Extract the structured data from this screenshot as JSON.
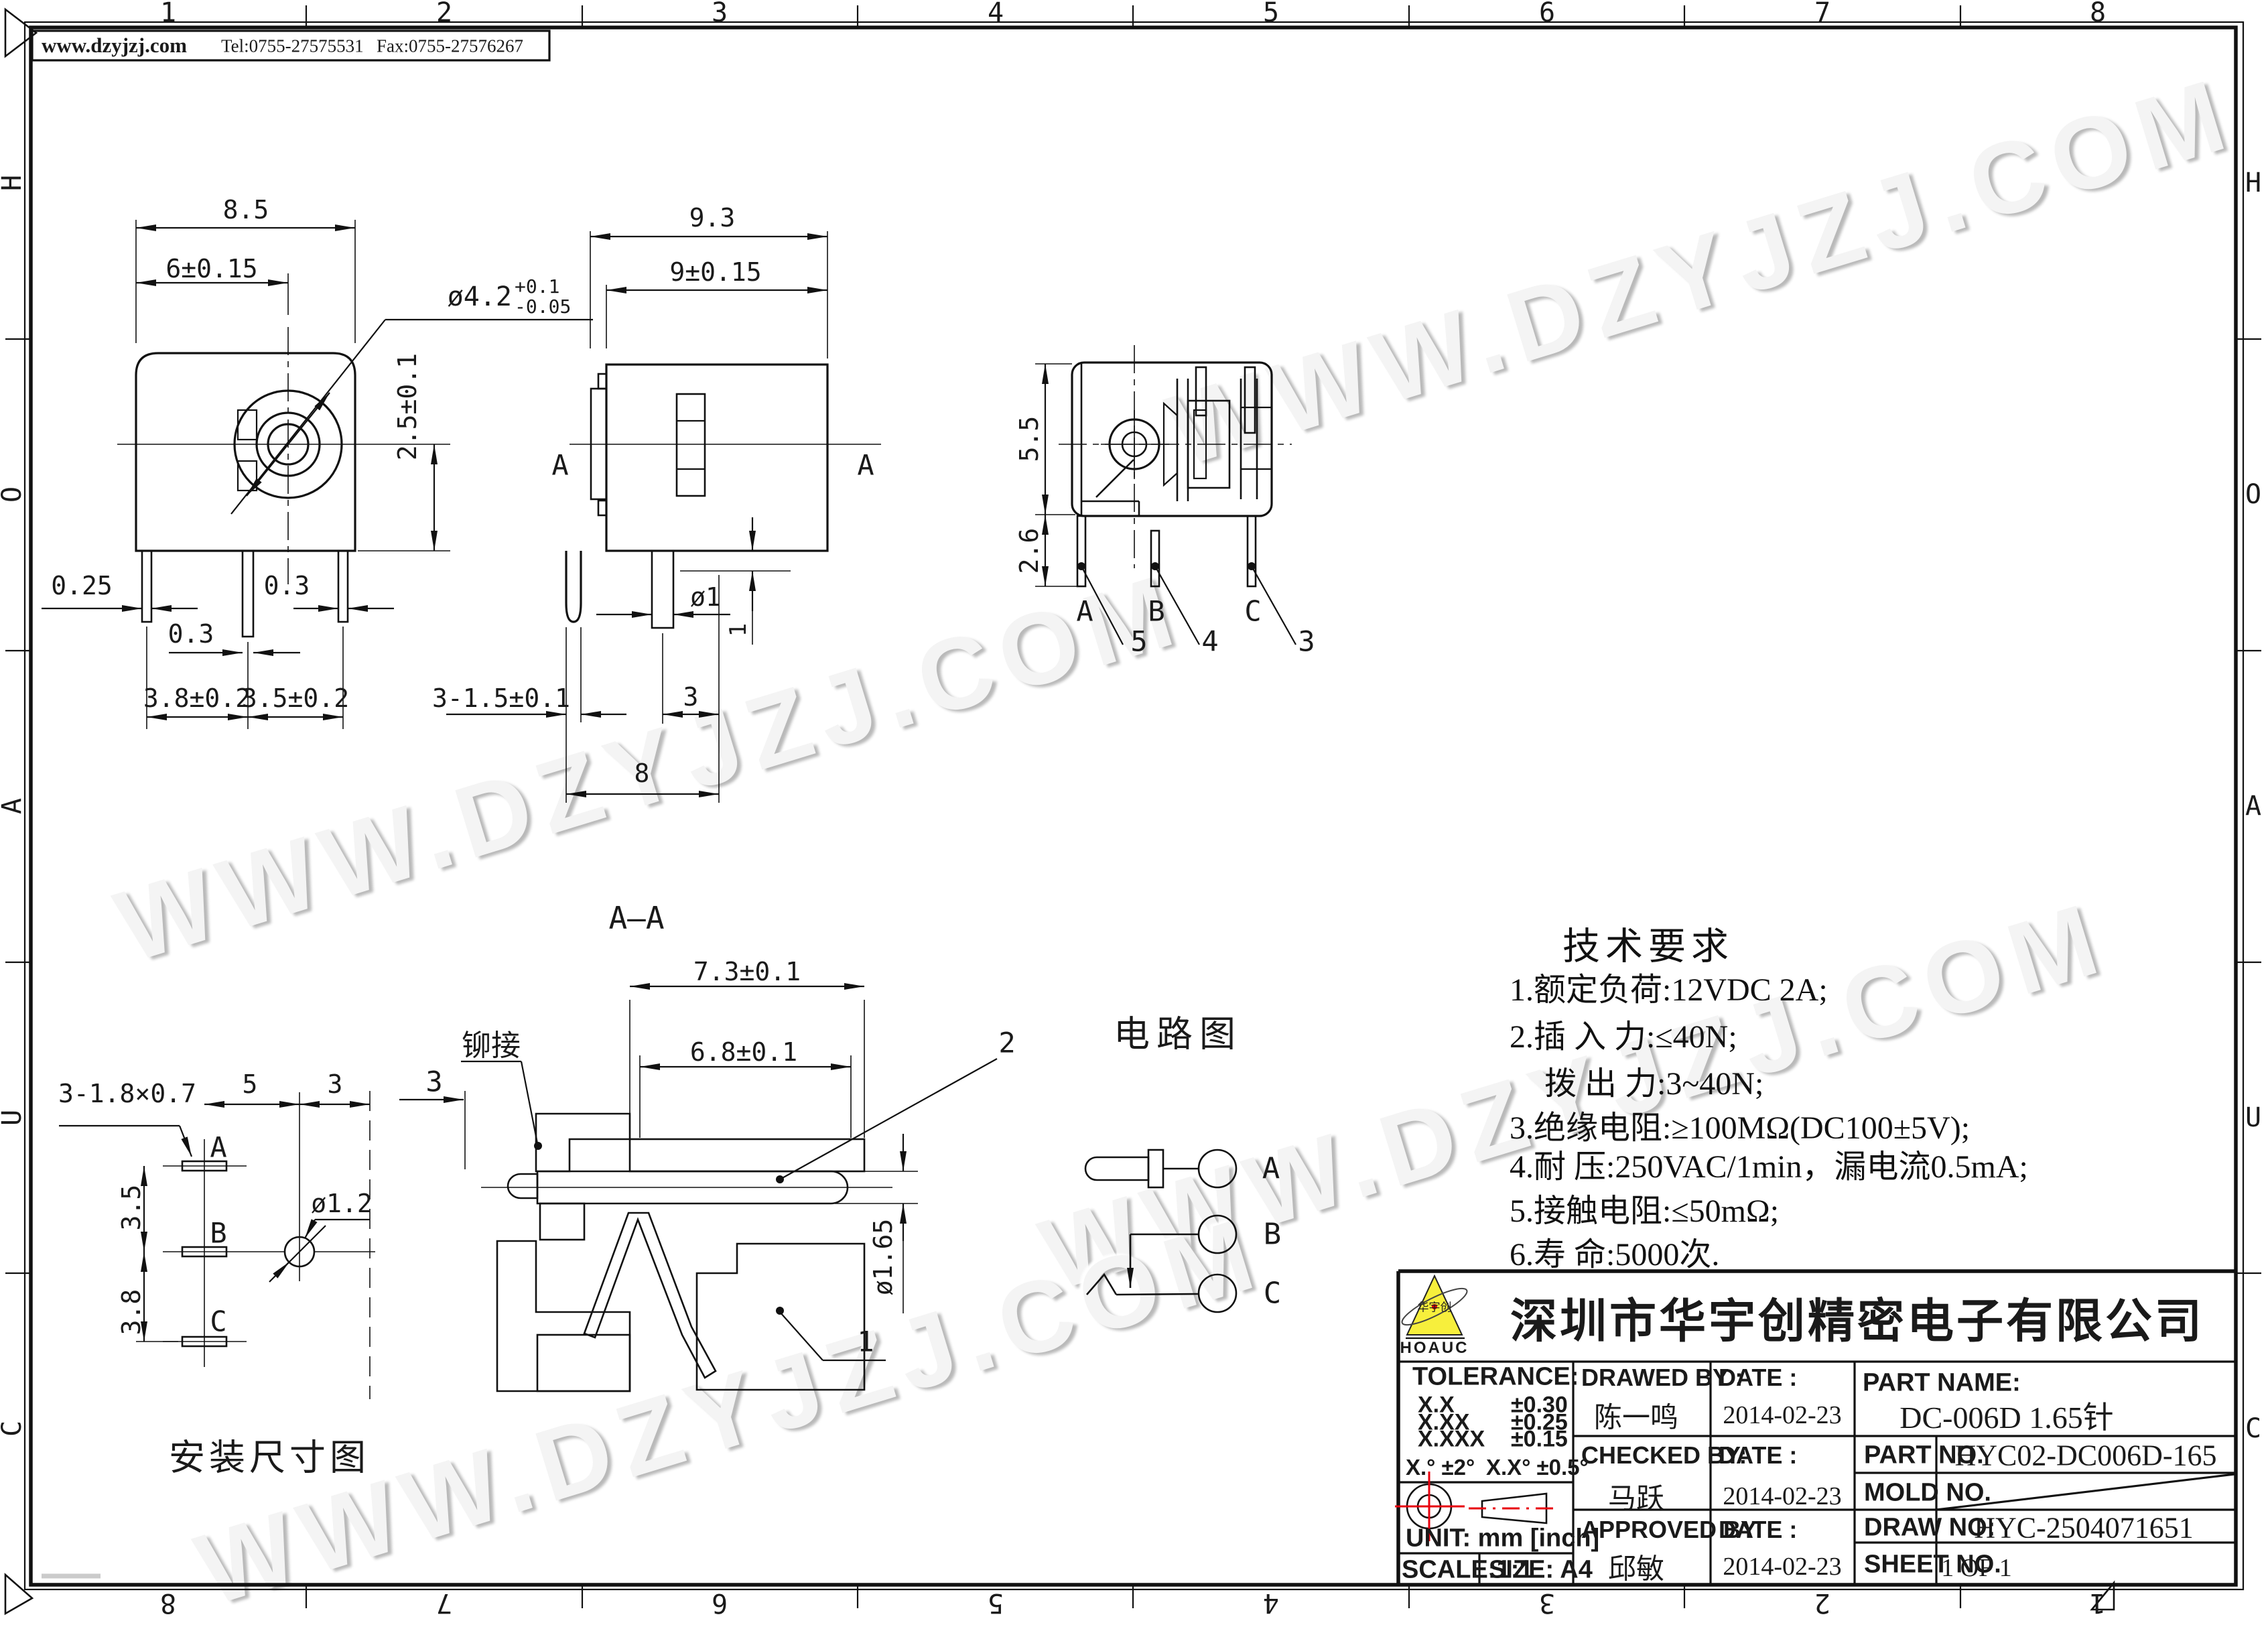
{
  "watermark": "WWW.DZYJZJ.COM",
  "header": {
    "website": "www.dzyjzj.com",
    "tel": "Tel:0755-27575531",
    "fax": "Fax:0755-27576267"
  },
  "border": {
    "top": [
      "1",
      "2",
      "3",
      "4",
      "5",
      "6",
      "7",
      "8"
    ],
    "bottom": [
      "8",
      "7",
      "6",
      "5",
      "4",
      "3",
      "2",
      "1"
    ],
    "left": [
      "H",
      "O",
      "A",
      "U",
      "C"
    ],
    "right": [
      "H",
      "O",
      "A",
      "U",
      "C"
    ]
  },
  "front": {
    "d85": "8.5",
    "d6": "6±0.15",
    "dia": {
      "main": "ø4.2",
      "plus": "+0.1",
      "minus": "-0.05"
    },
    "d25": "2.5±0.1",
    "d025": "0.25",
    "d03a": "0.3",
    "d03b": "0.3",
    "d38": "3.8±0.2",
    "d35": "3.5±0.2"
  },
  "side": {
    "d93": "9.3",
    "d9": "9±0.15",
    "a_left": "A",
    "a_right": "A",
    "d315": "3-1.5±0.1",
    "dphi1": "ø1",
    "d3": "3",
    "d8": "8",
    "d1": "1"
  },
  "rightview": {
    "d55": "5.5",
    "d26": "2.6",
    "pin_a": "A",
    "pin_b": "B",
    "pin_c": "C",
    "n5": "5",
    "n4": "4",
    "n3": "3"
  },
  "section": {
    "title": "A—A",
    "d73": "7.3±0.1",
    "d68": "6.8±0.1",
    "rivet": "铆接",
    "n3": "3",
    "n2": "2",
    "n1": "1",
    "dphi165": "ø1.65"
  },
  "circuit": {
    "title": "电路图",
    "a": "A",
    "b": "B",
    "c": "C"
  },
  "install": {
    "callout": "3-1.8×0.7",
    "d5": "5",
    "d3": "3",
    "a": "A",
    "b": "B",
    "c": "C",
    "d35": "3.5",
    "d38": "3.8",
    "dphi12": "ø1.2",
    "caption": "安装尺寸图"
  },
  "tech": {
    "title": "技术要求",
    "lines": [
      "1.额定负荷:12VDC 2A;",
      "2.插 入 力:≤40N;",
      "拨 出 力:3~40N;",
      "3.绝缘电阻:≥100MΩ(DC100±5V);",
      "4.耐    压:250VAC/1min，漏电流0.5mA;",
      "5.接触电阻:≤50mΩ;",
      "6.寿    命:5000次."
    ]
  },
  "title_block": {
    "company": {
      "name": "深圳市华宇创精密电子有限公司",
      "logo_text": "华宇创",
      "logo_sub": "HOAUC"
    },
    "tolerance": {
      "label": "TOLERANCE:",
      "r1l": "X.X",
      "r1v": "±0.30",
      "r2l": "X.XX",
      "r2v": "±0.25",
      "r3l": "X.XXX",
      "r3v": "±0.15",
      "ang1": "X.°  ±2°",
      "ang2": "X.X°  ±0.5°",
      "unit": "UNIT:  mm  [inch]",
      "scale": "SCALE:1:1",
      "size": "SIZE:  A4"
    },
    "people": {
      "drawed_label": "DRAWED BY :",
      "drawed": "陈一鸣",
      "checked_label": "CHECKED BY:",
      "checked": "马跃",
      "approved_label": "APPROVED BY:",
      "approved": "邱敏",
      "date_label1": "DATE :",
      "date_label2": "DATE :",
      "date_label3": "DATE :",
      "date1": "2014-02-23",
      "date2": "2014-02-23",
      "date3": "2014-02-23"
    },
    "part": {
      "name_label": "PART NAME:",
      "name": "DC-006D 1.65针",
      "no_label": "PART NO.",
      "no": "HYC02-DC006D-165",
      "mold_label": "MOLD NO.",
      "draw_label": "DRAW NO:",
      "draw": "HYC-2504071651",
      "sheet_label": "SHEET NO.",
      "sheet": "1 OF 1"
    }
  }
}
